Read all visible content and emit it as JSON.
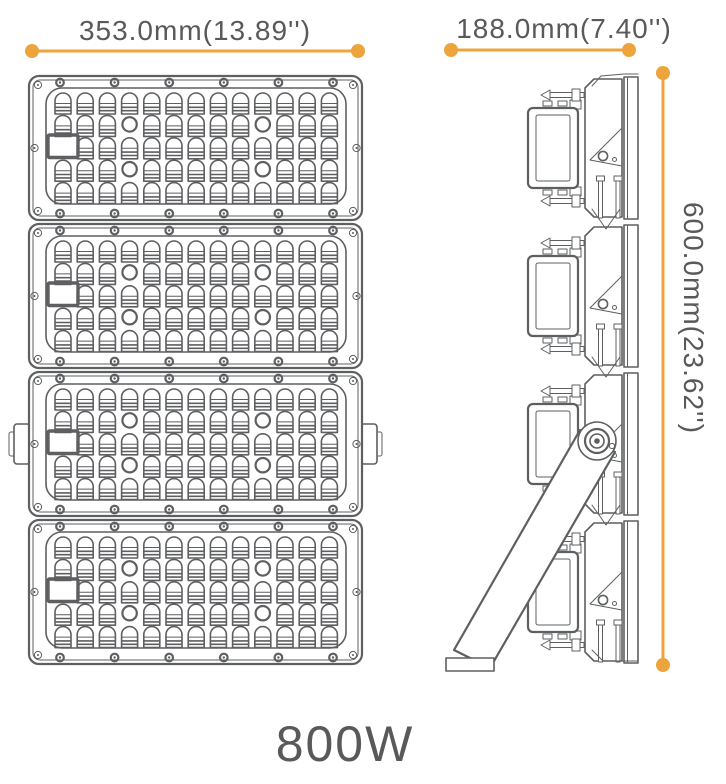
{
  "product": {
    "wattage_label": "800W"
  },
  "dimensions": {
    "width": {
      "label": "353.0mm(13.89'')",
      "value_mm": 353.0,
      "value_in": 13.89
    },
    "depth": {
      "label": "188.0mm(7.40'')",
      "value_mm": 188.0,
      "value_in": 7.4
    },
    "height": {
      "label": "600.0mm(23.62'')",
      "value_mm": 600.0,
      "value_in": 23.62
    }
  },
  "views": {
    "front": {
      "modules": 4,
      "led_columns": 13,
      "led_rows": 5,
      "circle_rows": [
        2,
        4
      ],
      "circle_cols": [
        4,
        10
      ],
      "window": {
        "row": 3,
        "col": 1
      }
    },
    "side": {
      "modules": 4
    }
  },
  "colors": {
    "accent": "#EDA43C",
    "line": "#5E5F61",
    "text": "#58595B",
    "background": "#FFFFFF"
  }
}
